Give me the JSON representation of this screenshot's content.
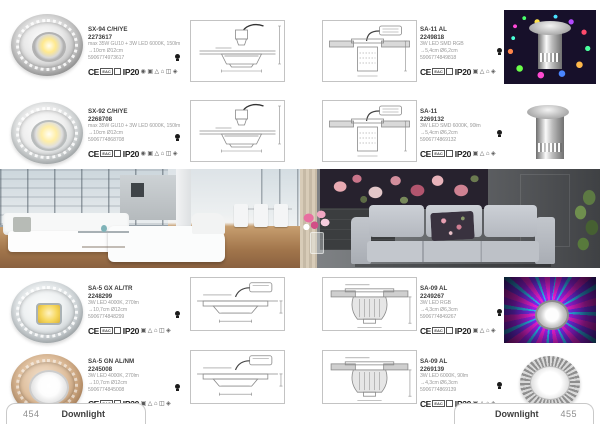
{
  "certifications": {
    "ce": "CE",
    "eac": "EAC",
    "ip": "IP20",
    "icons": [
      "◉",
      "▣",
      "△",
      "⌂",
      "◫",
      "◈"
    ]
  },
  "left_page": {
    "products": [
      {
        "name": "SX-94 C/H/YE",
        "code": "2273617",
        "spec": "max 35W GU10 + 3W LED 6000K, 150lm",
        "dimensions": "→10cm Ø12cm",
        "ean": "5906774973617"
      },
      {
        "name": "SX-92 C/H/YE",
        "code": "2268708",
        "spec": "max 35W GU10 + 3W LED 6000K, 150lm",
        "dimensions": "→10cm Ø12cm",
        "ean": "5906774868708"
      },
      {
        "name": "SA-5 GX AL/TR",
        "code": "2248299",
        "spec": "3W LED 4000K, 270lm",
        "dimensions": "→10,7cm Ø12cm",
        "ean": "5906774848299"
      },
      {
        "name": "SA-5 GN AL/NM",
        "code": "2245008",
        "spec": "3W LED 4000K, 270lm",
        "dimensions": "→10,7cm Ø12cm",
        "ean": "5906774845008"
      }
    ],
    "footer": {
      "page_number": "454",
      "label": "Downlight"
    }
  },
  "right_page": {
    "products": [
      {
        "name": "SA-11 AL",
        "code": "2249818",
        "spec": "3W LED SMD RGB",
        "dimensions": "→5,4cm Ø6,2cm",
        "ean": "5906774849818"
      },
      {
        "name": "SA-11",
        "code": "2269132",
        "spec": "3W LED SMD 6000K, 90lm",
        "dimensions": "→5,4cm Ø6,2cm",
        "ean": "5906774869132"
      },
      {
        "name": "SA-09 AL",
        "code": "2249267",
        "spec": "3W LED RGB",
        "dimensions": "→4,3cm Ø6,3cm",
        "ean": "5906774849267"
      },
      {
        "name": "SA-09 AL",
        "code": "2269139",
        "spec": "3W LED 6000K, 90lm",
        "dimensions": "→4,3cm Ø6,3cm",
        "ean": "5906774869139"
      }
    ],
    "footer": {
      "page_number": "455",
      "label": "Downlight"
    }
  },
  "colors": {
    "page_bg": "#ffffff",
    "spec_text": "#9b9b9b",
    "rgb_photo_bg": "#17102a",
    "wood_floor": "#a1754b",
    "dark_wall": "#4a4c4f"
  }
}
